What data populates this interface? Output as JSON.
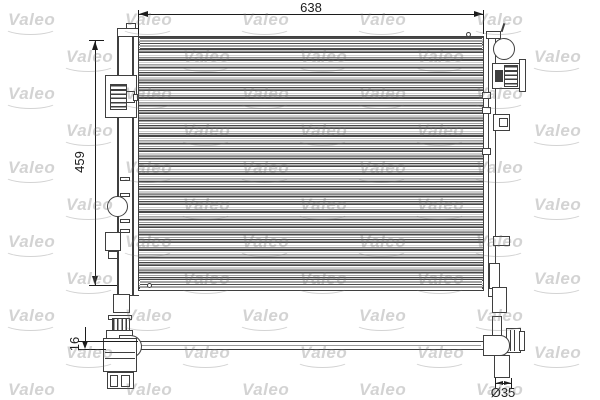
{
  "watermark": {
    "label": "Valeo"
  },
  "dimensions": {
    "core_width": "638",
    "core_height": "459",
    "core_thickness": "16",
    "pipe_diameter": "Ø35"
  },
  "colors": {
    "line": "#3f3f3f",
    "dim_text": "#1c1c1c",
    "core_band": "#c6c6c6",
    "watermark": "rgba(110,110,110,0.30)",
    "background": "#ffffff"
  }
}
